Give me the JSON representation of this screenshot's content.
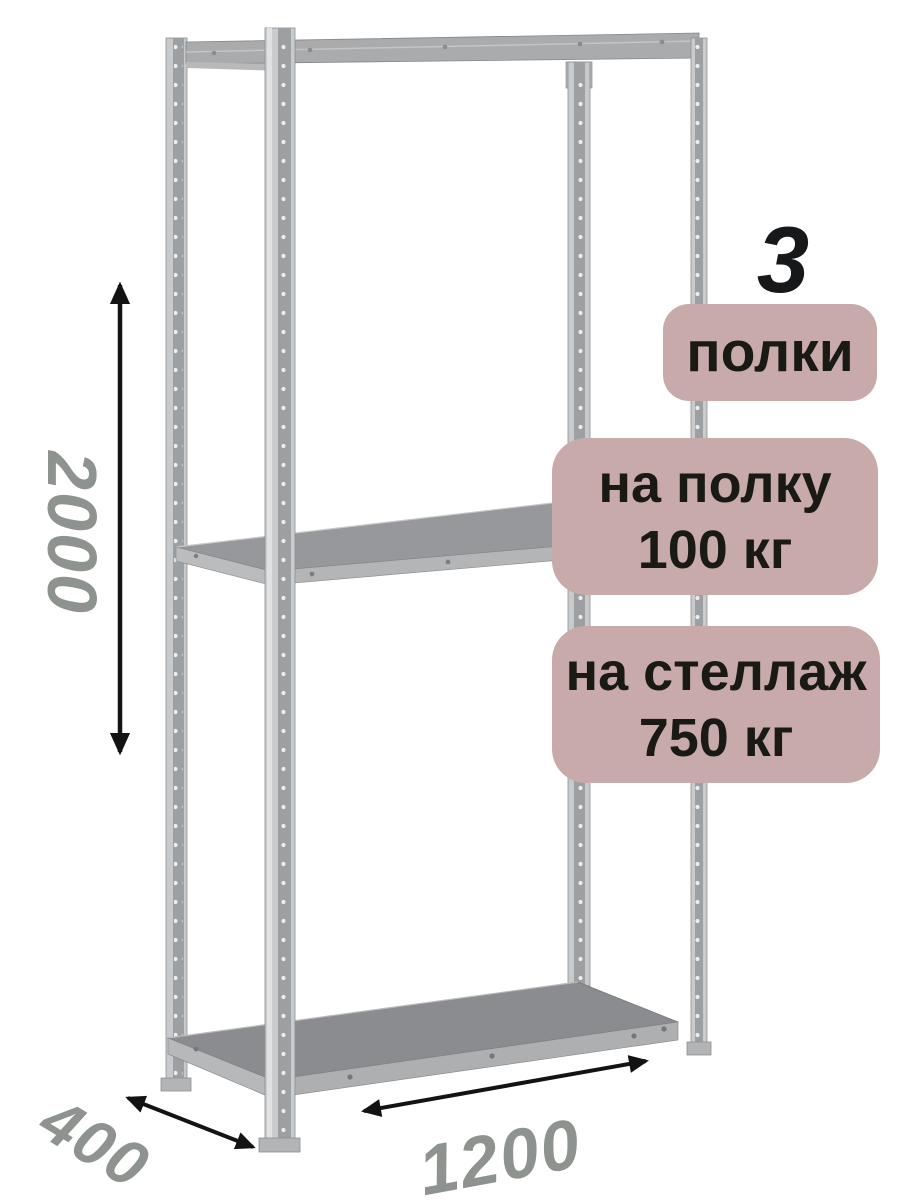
{
  "page": {
    "background": "#ffffff"
  },
  "rack": {
    "shelves_visible": 3,
    "posts_visible": 4,
    "colors": {
      "metal_light": "#c9cbcd",
      "metal_channel": "#9da0a2",
      "perforation_dot": "#ecedee",
      "beam": "#a9abad",
      "shelf_top": "#8a8c8f",
      "shelf_edge": "#adafb1"
    }
  },
  "dimensions": {
    "height": "2000",
    "depth": "400",
    "width": "1200",
    "label_color": "#8e938f",
    "arrow_color": "#131313",
    "arrow_icon": "double-headed-arrow"
  },
  "annotations": {
    "badge_bg": "#c8aaaa",
    "badge_text_color": "#191a14",
    "shelf_count": {
      "value": "3",
      "label": "полки"
    },
    "per_shelf": {
      "line1": "на полку",
      "line2": "100 кг"
    },
    "per_rack": {
      "line1": "на стеллаж",
      "line2": "750 кг"
    }
  }
}
